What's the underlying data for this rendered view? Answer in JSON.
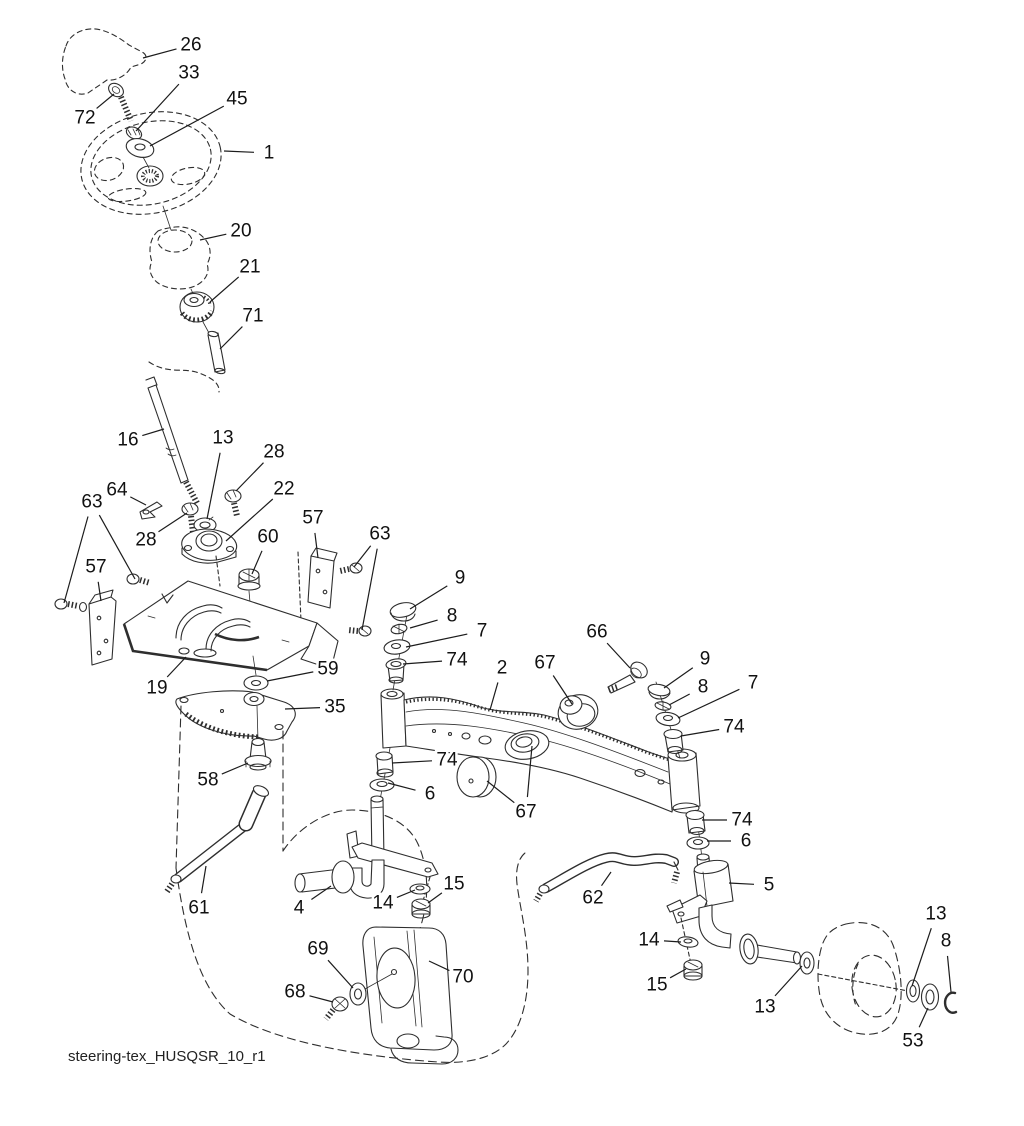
{
  "diagram": {
    "footer": "steering-tex_HUSQSR_10_r1",
    "colors": {
      "ink": "#2e2e2e",
      "background": "#ffffff"
    },
    "canvas": {
      "width": 1024,
      "height": 1126
    },
    "callouts": [
      {
        "label": "26",
        "x": 191,
        "y": 45,
        "targets": [
          [
            143,
            58
          ]
        ]
      },
      {
        "label": "33",
        "x": 189,
        "y": 73,
        "targets": [
          [
            136,
            131
          ]
        ]
      },
      {
        "label": "45",
        "x": 237,
        "y": 99,
        "targets": [
          [
            150,
            146
          ]
        ]
      },
      {
        "label": "72",
        "x": 85,
        "y": 118,
        "targets": [
          [
            114,
            94
          ]
        ]
      },
      {
        "label": "1",
        "x": 269,
        "y": 153,
        "targets": [
          [
            224,
            151
          ]
        ]
      },
      {
        "label": "20",
        "x": 241,
        "y": 231,
        "targets": [
          [
            200,
            240
          ]
        ]
      },
      {
        "label": "21",
        "x": 250,
        "y": 267,
        "targets": [
          [
            210,
            302
          ]
        ]
      },
      {
        "label": "71",
        "x": 253,
        "y": 316,
        "targets": [
          [
            220,
            349
          ]
        ]
      },
      {
        "label": "16",
        "x": 128,
        "y": 440,
        "targets": [
          [
            164,
            429
          ]
        ]
      },
      {
        "label": "13",
        "x": 223,
        "y": 438,
        "targets": [
          [
            207,
            519
          ]
        ]
      },
      {
        "label": "28",
        "x": 274,
        "y": 452,
        "targets": [
          [
            236,
            491
          ]
        ]
      },
      {
        "label": "64",
        "x": 117,
        "y": 490,
        "targets": [
          [
            146,
            505
          ]
        ]
      },
      {
        "label": "22",
        "x": 284,
        "y": 489,
        "targets": [
          [
            226,
            541
          ]
        ]
      },
      {
        "label": "28",
        "x": 146,
        "y": 540,
        "targets": [
          [
            187,
            513
          ]
        ]
      },
      {
        "label": "60",
        "x": 268,
        "y": 537,
        "targets": [
          [
            252,
            574
          ]
        ]
      },
      {
        "label": "57",
        "x": 313,
        "y": 518,
        "targets": [
          [
            318,
            558
          ]
        ]
      },
      {
        "label": "63",
        "x": 380,
        "y": 534,
        "targets": [
          [
            354,
            567
          ],
          [
            362,
            630
          ]
        ]
      },
      {
        "label": "63",
        "x": 92,
        "y": 502,
        "targets": [
          [
            64,
            603
          ],
          [
            135,
            579
          ]
        ]
      },
      {
        "label": "57",
        "x": 96,
        "y": 567,
        "targets": [
          [
            101,
            601
          ]
        ]
      },
      {
        "label": "9",
        "x": 460,
        "y": 578,
        "targets": [
          [
            410,
            609
          ]
        ]
      },
      {
        "label": "8",
        "x": 452,
        "y": 616,
        "targets": [
          [
            410,
            628
          ]
        ]
      },
      {
        "label": "7",
        "x": 482,
        "y": 631,
        "targets": [
          [
            406,
            647
          ]
        ]
      },
      {
        "label": "74",
        "x": 457,
        "y": 660,
        "targets": [
          [
            403,
            664
          ]
        ]
      },
      {
        "label": "2",
        "x": 502,
        "y": 668,
        "targets": [
          [
            490,
            710
          ]
        ]
      },
      {
        "label": "67",
        "x": 545,
        "y": 663,
        "targets": [
          [
            572,
            704
          ]
        ]
      },
      {
        "label": "66",
        "x": 597,
        "y": 632,
        "targets": [
          [
            630,
            668
          ]
        ]
      },
      {
        "label": "9",
        "x": 705,
        "y": 659,
        "targets": [
          [
            664,
            688
          ]
        ]
      },
      {
        "label": "8",
        "x": 703,
        "y": 687,
        "targets": [
          [
            669,
            705
          ]
        ]
      },
      {
        "label": "7",
        "x": 753,
        "y": 683,
        "targets": [
          [
            678,
            718
          ]
        ]
      },
      {
        "label": "74",
        "x": 734,
        "y": 727,
        "targets": [
          [
            681,
            736
          ]
        ]
      },
      {
        "label": "19",
        "x": 157,
        "y": 688,
        "targets": [
          [
            186,
            657
          ]
        ]
      },
      {
        "label": "59",
        "x": 328,
        "y": 669,
        "targets": [
          [
            267,
            681
          ]
        ]
      },
      {
        "label": "35",
        "x": 335,
        "y": 707,
        "targets": [
          [
            285,
            709
          ]
        ]
      },
      {
        "label": "58",
        "x": 208,
        "y": 780,
        "targets": [
          [
            248,
            763
          ]
        ]
      },
      {
        "label": "74",
        "x": 447,
        "y": 760,
        "targets": [
          [
            392,
            763
          ]
        ]
      },
      {
        "label": "6",
        "x": 430,
        "y": 794,
        "targets": [
          [
            388,
            783
          ]
        ]
      },
      {
        "label": "67",
        "x": 526,
        "y": 812,
        "targets": [
          [
            487,
            781
          ],
          [
            532,
            746
          ]
        ]
      },
      {
        "label": "74",
        "x": 742,
        "y": 820,
        "targets": [
          [
            702,
            820
          ]
        ]
      },
      {
        "label": "6",
        "x": 746,
        "y": 841,
        "targets": [
          [
            707,
            841
          ]
        ]
      },
      {
        "label": "5",
        "x": 769,
        "y": 885,
        "targets": [
          [
            729,
            883
          ]
        ]
      },
      {
        "label": "61",
        "x": 199,
        "y": 908,
        "targets": [
          [
            206,
            866
          ]
        ]
      },
      {
        "label": "4",
        "x": 299,
        "y": 908,
        "targets": [
          [
            331,
            886
          ]
        ]
      },
      {
        "label": "14",
        "x": 383,
        "y": 903,
        "targets": [
          [
            415,
            890
          ]
        ]
      },
      {
        "label": "15",
        "x": 454,
        "y": 884,
        "targets": [
          [
            428,
            903
          ]
        ]
      },
      {
        "label": "62",
        "x": 593,
        "y": 898,
        "targets": [
          [
            611,
            872
          ]
        ]
      },
      {
        "label": "14",
        "x": 649,
        "y": 940,
        "targets": [
          [
            681,
            942
          ]
        ]
      },
      {
        "label": "15",
        "x": 657,
        "y": 985,
        "targets": [
          [
            686,
            969
          ]
        ]
      },
      {
        "label": "13",
        "x": 765,
        "y": 1007,
        "targets": [
          [
            802,
            966
          ]
        ]
      },
      {
        "label": "13",
        "x": 936,
        "y": 914,
        "targets": [
          [
            912,
            986
          ]
        ]
      },
      {
        "label": "8",
        "x": 946,
        "y": 941,
        "targets": [
          [
            951,
            992
          ]
        ]
      },
      {
        "label": "53",
        "x": 913,
        "y": 1041,
        "targets": [
          [
            928,
            1008
          ]
        ]
      },
      {
        "label": "69",
        "x": 318,
        "y": 949,
        "targets": [
          [
            353,
            988
          ]
        ]
      },
      {
        "label": "70",
        "x": 463,
        "y": 977,
        "targets": [
          [
            429,
            961
          ]
        ]
      },
      {
        "label": "68",
        "x": 295,
        "y": 992,
        "targets": [
          [
            333,
            1002
          ]
        ]
      }
    ]
  }
}
